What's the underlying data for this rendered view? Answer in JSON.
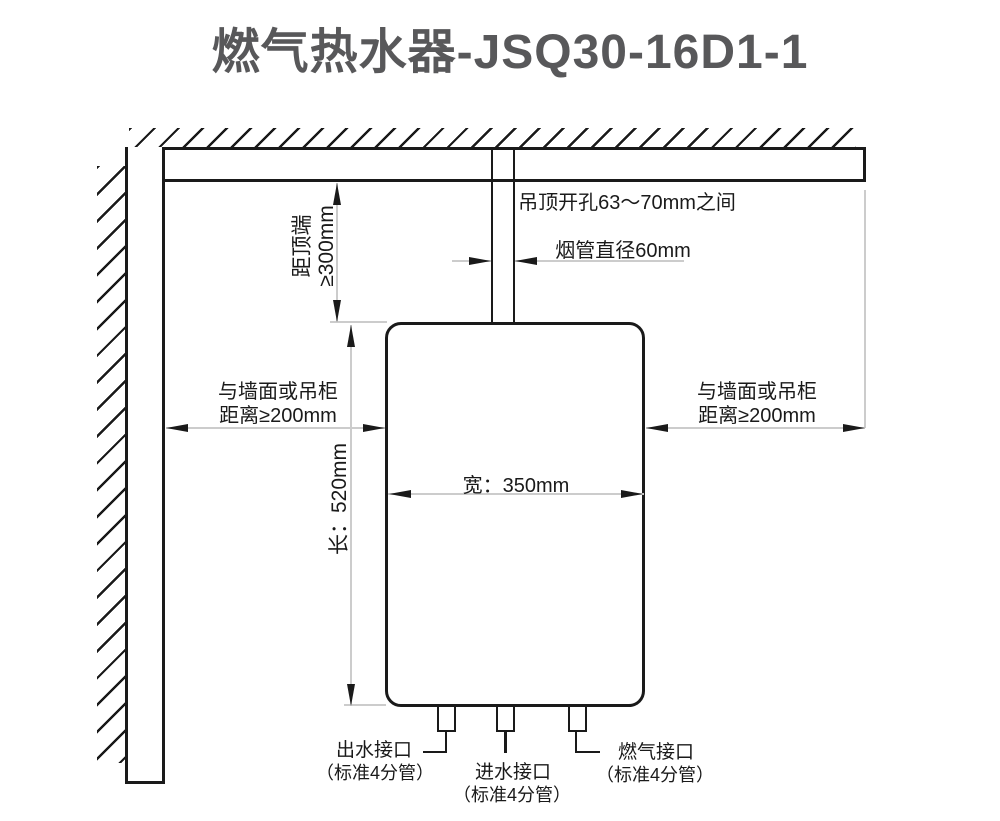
{
  "title": "燃气热水器-JSQ30-16D1-1",
  "notes": {
    "ceiling_hole": "吊顶开孔63～70mm之间",
    "flue_diameter": "烟管直径60mm"
  },
  "dimensions": {
    "top_clearance": {
      "label": "距顶端",
      "value": "≥300mm"
    },
    "left_clearance": {
      "line1": "与墙面或吊柜",
      "line2": "距离≥200mm"
    },
    "right_clearance": {
      "line1": "与墙面或吊柜",
      "line2": "距离≥200mm"
    },
    "unit_width": "宽：350mm",
    "unit_height": "长：520mm"
  },
  "connections": {
    "outlet": {
      "label": "出水接口",
      "spec": "（标准4分管）"
    },
    "inlet": {
      "label": "进水接口",
      "spec": "（标准4分管）"
    },
    "gas": {
      "label": "燃气接口",
      "spec": "（标准4分管）"
    }
  },
  "colors": {
    "outline": "#1a1a1a",
    "dim_line": "#cccccc",
    "title": "#58585a"
  }
}
